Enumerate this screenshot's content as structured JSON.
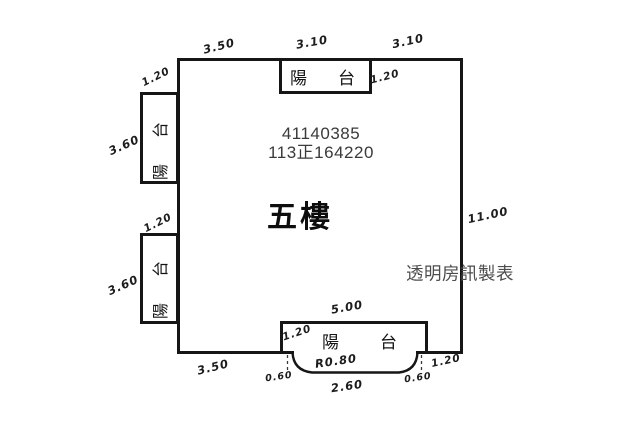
{
  "plan": {
    "floor_label": "五樓",
    "serial_line1": "41140385",
    "serial_line2": "113正164220",
    "watermark": "透明房訊製表"
  },
  "balconies": {
    "top_label": "陽台",
    "left_upper_label": "陽台",
    "left_lower_label": "陽台",
    "bottom_label": "陽台"
  },
  "dimensions": [
    {
      "text": "3.50",
      "location": "top-edge-left"
    },
    {
      "text": "3.10",
      "location": "top-edge-middle"
    },
    {
      "text": "3.10",
      "location": "top-edge-right"
    },
    {
      "text": "1.20",
      "location": "left-upper-balcony-width"
    },
    {
      "text": "1.20",
      "location": "top-balcony-depth"
    },
    {
      "text": "3.60",
      "location": "left-upper-balcony-height"
    },
    {
      "text": "1.20",
      "location": "left-lower-balcony-width"
    },
    {
      "text": "3.60",
      "location": "left-lower-balcony-height"
    },
    {
      "text": "11.00",
      "location": "right-edge"
    },
    {
      "text": "5.00",
      "location": "bottom-balcony-width"
    },
    {
      "text": "1.20",
      "location": "bottom-balcony-depth-left"
    },
    {
      "text": "R0.80",
      "location": "balcony-curve-radius"
    },
    {
      "text": "2.60",
      "location": "balcony-curve-flat-width"
    },
    {
      "text": "0.60",
      "location": "curve-offset-left"
    },
    {
      "text": "0.60",
      "location": "curve-offset-right"
    },
    {
      "text": "1.20",
      "location": "bottom-balcony-depth-right"
    },
    {
      "text": "3.50",
      "location": "bottom-edge-left"
    }
  ]
}
